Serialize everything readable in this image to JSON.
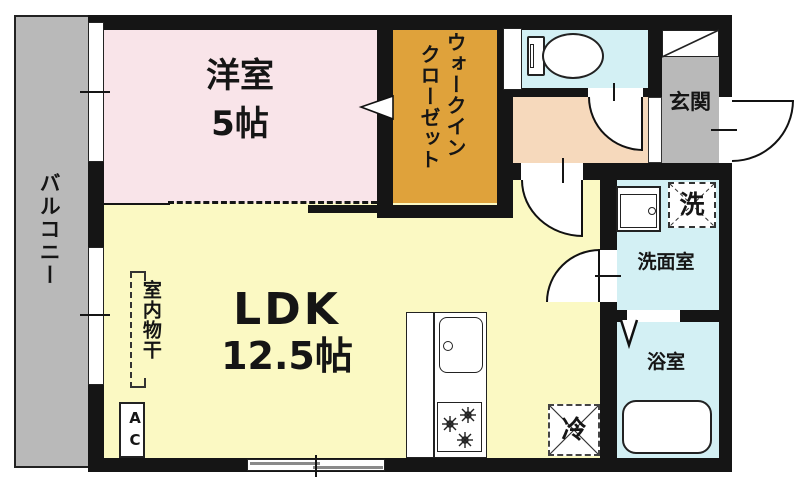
{
  "plan": {
    "type": "apartment-floor-plan",
    "rooms": {
      "balcony": {
        "label": "バルコニー"
      },
      "western": {
        "label": "洋室",
        "size": "5帖"
      },
      "wic": {
        "line1": "ウォークイン",
        "line2": "クローゼット"
      },
      "ldk": {
        "label": "LDK",
        "size": "12.5帖"
      },
      "genkan": {
        "label": "玄関"
      },
      "washroom": {
        "label": "洗面室"
      },
      "bathroom": {
        "label": "浴室"
      }
    },
    "fixtures": {
      "washer": {
        "label": "洗"
      },
      "fridge": {
        "label": "冷"
      },
      "ac": {
        "label": "AC"
      },
      "indoor_drying": {
        "label": "室内物干"
      }
    },
    "colors": {
      "wall": "#151515",
      "western_room": "#f9e4e9",
      "ldk": "#fbf9c3",
      "wic": "#dfa23b",
      "wet_rooms": "#d3f0f4",
      "hallway": "#f6d9bc",
      "genkan": "#b9b9b9",
      "balcony": "#b9b9b9"
    }
  }
}
